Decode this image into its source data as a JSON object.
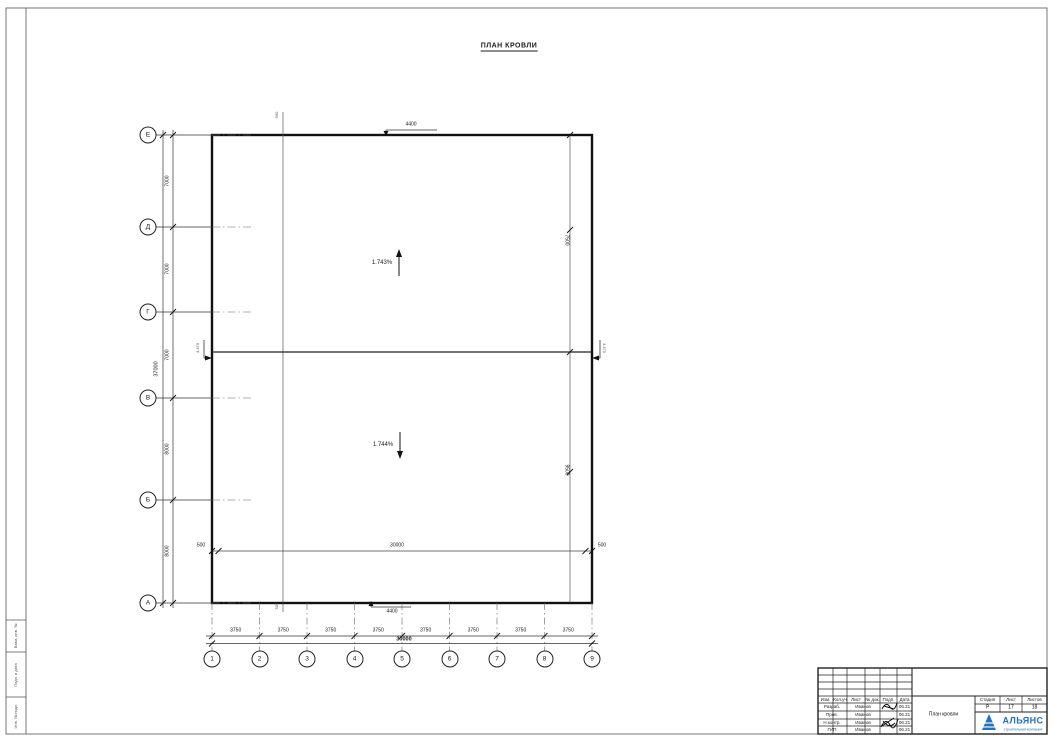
{
  "sheet": {
    "title": "ПЛАН КРОВЛИ"
  },
  "plan": {
    "slope_up": "1.743%",
    "slope_down": "1.744%",
    "elevation_left": "4.470",
    "elevation_right": "4.470"
  },
  "axes": {
    "rows": [
      "Е",
      "Д",
      "Г",
      "В",
      "Б",
      "А"
    ],
    "cols": [
      "1",
      "2",
      "3",
      "4",
      "5",
      "6",
      "7",
      "8",
      "9"
    ]
  },
  "dims": {
    "row_segments": [
      "7000",
      "7000",
      "7000",
      "8000",
      "8000"
    ],
    "row_total": "37000",
    "col_segments": [
      "3750",
      "3750",
      "3750",
      "3750",
      "3750",
      "3750",
      "3750",
      "3750"
    ],
    "col_total": "30000",
    "top_offset": "500",
    "bottom_offset": "500",
    "top_leader": "4400",
    "bottom_leader": "4400",
    "inner_left": "500",
    "inner_center": "30000",
    "inner_right": "500",
    "right_upper": "7500",
    "right_lower": "9500"
  },
  "titleblock": {
    "change_header": [
      "Изм.",
      "Кол.уч",
      "Лист",
      "№ док.",
      "Подп.",
      "Дата"
    ],
    "rows": [
      {
        "role": "Разраб.",
        "name": "Иванов",
        "date": "06.21"
      },
      {
        "role": "Пров.",
        "name": "Иванов",
        "date": "06.21"
      },
      {
        "role": "Н.контр.",
        "name": "Иванов",
        "date": "06.21"
      },
      {
        "role": "ГИП",
        "name": "Иванов",
        "date": "06.21"
      }
    ],
    "doc_name": "План кровли",
    "stage_header": [
      "Стадия",
      "Лист",
      "Листов"
    ],
    "stage_values": [
      "Р",
      "17",
      "18"
    ],
    "company": "АЛЬЯНС",
    "company_sub": "строительная компания",
    "brand_color": "#2472b9"
  },
  "side_stamp": [
    "Взам. инв. №",
    "Подп. и дата",
    "Инв. № подл."
  ]
}
